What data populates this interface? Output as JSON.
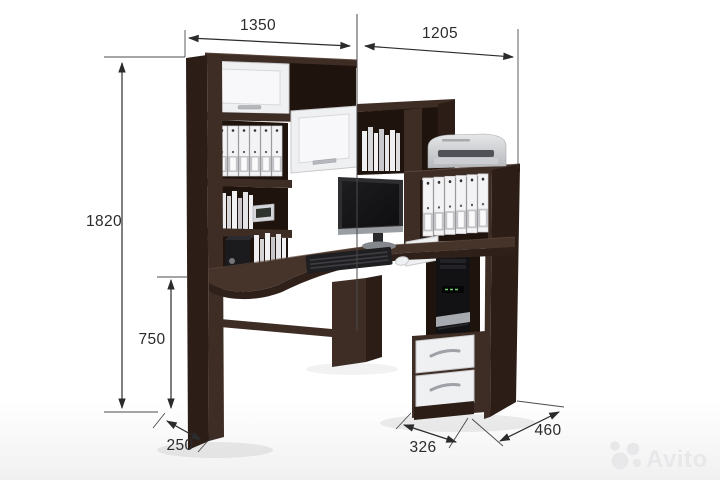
{
  "dimensions": {
    "width_left": "1350",
    "width_right": "1205",
    "height_total": "1820",
    "height_desk": "750",
    "depth_left": "250",
    "depth_front": "326",
    "depth_right": "460"
  },
  "watermark": {
    "text": "Avito"
  },
  "colors": {
    "background": "#ffffff",
    "wood_front": "#3e2d25",
    "wood_side": "#2c1e17",
    "wood_interior": "#1f140d",
    "wood_top": "#46332a",
    "wood_edge": "#2f211a",
    "white_front": "#eff0f1",
    "white_inset": "#f8f8fa",
    "gray_border": "#c9c9cd",
    "silver": "#b5b8bc",
    "device_black": "#17171a",
    "dim_line": "#2b2b2b",
    "watermark_gray": "#e8e8ea"
  }
}
